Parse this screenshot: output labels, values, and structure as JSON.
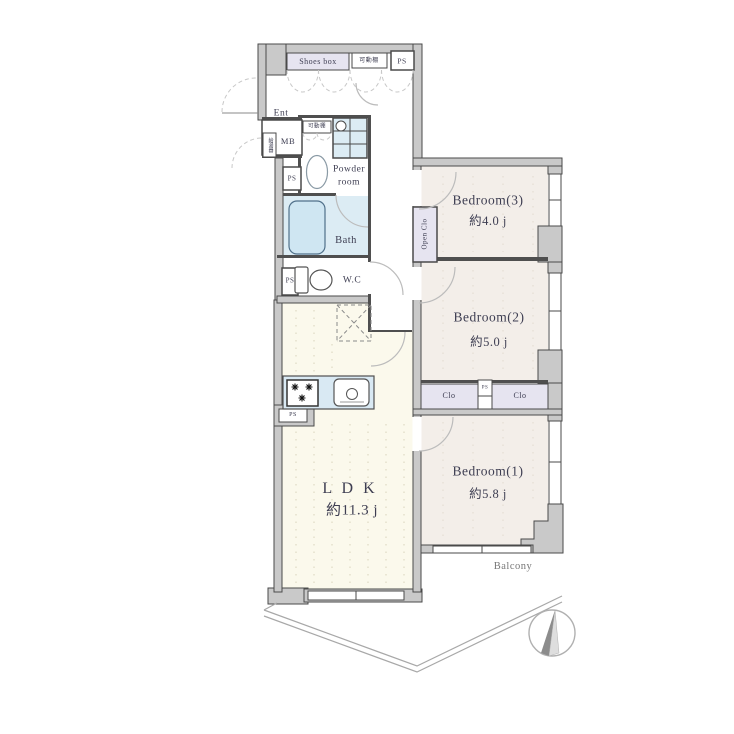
{
  "labels": {
    "shoes_box": "Shoes box",
    "shelf_top": "可動棚",
    "ps_top": "PS",
    "ent": "Ent",
    "mb": "MB",
    "water_heater": "給湯器",
    "shelf_mid": "可動棚",
    "powder_line1": "Powder",
    "powder_line2": "room",
    "ps_left": "PS",
    "bath": "Bath",
    "ps_wc": "PS",
    "wc": "W.C",
    "ps_kitchen": "PS",
    "open_clo": "Open Clo",
    "clo_left": "Clo",
    "ps_between_clo": "PS",
    "clo_right": "Clo",
    "balcony": "Balcony"
  },
  "rooms": {
    "ldk": {
      "name": "L D K",
      "size": "約11.3 j"
    },
    "bedroom1": {
      "name": "Bedroom(1)",
      "size": "約5.8 j"
    },
    "bedroom2": {
      "name": "Bedroom(2)",
      "size": "約5.0 j"
    },
    "bedroom3": {
      "name": "Bedroom(3)",
      "size": "約4.0 j"
    }
  },
  "colors": {
    "wall_fill": "#c9c9c9",
    "wall_line": "#4a4a4a",
    "bedroom_floor": "#f3eee9",
    "ldk_floor": "#fbf9ec",
    "wet_area": "#dcecf4",
    "closet": "#e6e4f0",
    "text": "#3e3e52"
  }
}
